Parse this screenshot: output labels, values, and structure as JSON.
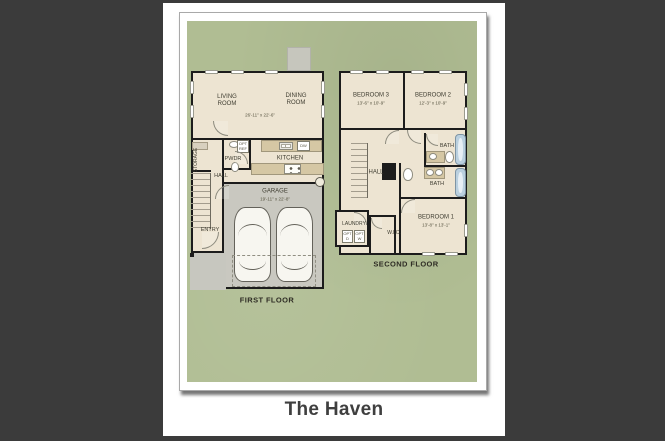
{
  "title": "The Haven",
  "colors": {
    "backdrop": "#3b3b3b",
    "panel": "#ffffff",
    "plan-bg": "#b0bd93",
    "floor": "#ede4d2",
    "garage-floor": "#c9c8c0",
    "wall": "#1c1c1c",
    "counter": "#d5c7a4",
    "tub": "#bad0df",
    "ink": "#3f3d31"
  },
  "first_floor": {
    "caption": "FIRST FLOOR",
    "living_room": "LIVING\nROOM",
    "dining_room": "DINING\nROOM",
    "great_room_dim": "26'-11\" x 22'-6\"",
    "storage": "STORAGE",
    "hall": "HALL",
    "powder": "PWDR",
    "kitchen": "KITCHEN",
    "opt_ref": "OPT\nREF",
    "dishwasher": "DW",
    "entry": "ENTRY",
    "garage": "GARAGE",
    "garage_dim": "19'-11\" x 22'-8\""
  },
  "second_floor": {
    "caption": "SECOND FLOOR",
    "bedroom3": "BEDROOM 3",
    "bedroom3_dim": "13'-6\" x 10'-9\"",
    "bedroom2": "BEDROOM 2",
    "bedroom2_dim": "12'-3\" x 10'-9\"",
    "bath_upper": "BATH",
    "bath_lower": "BATH",
    "hall": "HALL",
    "laundry": "LAUNDRY",
    "opt_dryer": "OPT\nD",
    "opt_washer": "OPT\nW",
    "wic": "W.I.C.",
    "bedroom1": "BEDROOM 1",
    "bedroom1_dim": "13'-8\" x 13'-1\""
  }
}
